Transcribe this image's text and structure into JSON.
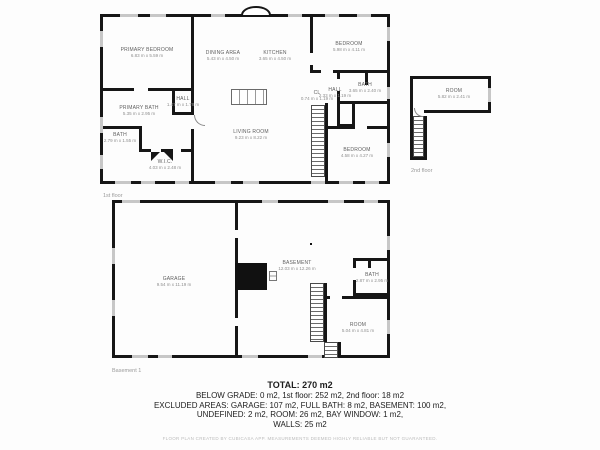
{
  "floors": {
    "first": {
      "label": "1st floor",
      "rooms": [
        {
          "name": "PRIMARY BEDROOM",
          "dims": "6.83 m x 5.59 m"
        },
        {
          "name": "DINING AREA",
          "dims": "5.43 m x 4.50 m"
        },
        {
          "name": "KITCHEN",
          "dims": "3.65 m x 4.50 m"
        },
        {
          "name": "BEDROOM",
          "dims": "5.98 m x 4.11 m"
        },
        {
          "name": "HALL",
          "dims": "1.47 m x 1.78 m"
        },
        {
          "name": "PRIMARY BATH",
          "dims": "5.35 m x 2.95 m"
        },
        {
          "name": "BATH",
          "dims": "2.79 m x 1.55 m"
        },
        {
          "name": "W.I.C.",
          "dims": "4.03 m x 2.48 m"
        },
        {
          "name": "LIVING ROOM",
          "dims": "9.23 m x 8.22 m"
        },
        {
          "name": "CL",
          "dims": "0.74 m x 1.19 m"
        },
        {
          "name": "HALL",
          "dims": "2.33 m x 1.19 m"
        },
        {
          "name": "BATH",
          "dims": "3.65 m x 2.40 m"
        },
        {
          "name": "BEDROOM",
          "dims": "4.58 m x 4.27 m"
        }
      ]
    },
    "second": {
      "label": "2nd floor",
      "rooms": [
        {
          "name": "ROOM",
          "dims": "5.82 m x 2.41 m"
        }
      ]
    },
    "basement": {
      "label": "Basement 1",
      "rooms": [
        {
          "name": "GARAGE",
          "dims": "9.54 m x 11.19 m"
        },
        {
          "name": "BASEMENT",
          "dims": "12.03 m x 12.26 m"
        },
        {
          "name": "BATH",
          "dims": "2.87 m x 2.95 m"
        },
        {
          "name": "ROOM",
          "dims": "5.04 m x 4.81 m"
        }
      ]
    }
  },
  "summary": {
    "total": "TOTAL: 270 m2",
    "line1": "BELOW GRADE: 0 m2, 1st floor: 252 m2, 2nd floor: 18 m2",
    "line2": "EXCLUDED AREAS: GARAGE: 107 m2, FULL BATH: 8 m2, BASEMENT: 100 m2,",
    "line3": "UNDEFINED: 2 m2, ROOM: 26 m2, BAY WINDOW: 1 m2,",
    "line4": "WALLS: 25 m2",
    "disclaimer": "FLOOR PLAN CREATED BY CUBICASA APP. MEASUREMENTS DEEMED HIGHLY RELIABLE BUT NOT GUARANTEED."
  },
  "colors": {
    "wall": "#161616",
    "window": "#c7c7c7",
    "background": "#fdfdfd"
  }
}
